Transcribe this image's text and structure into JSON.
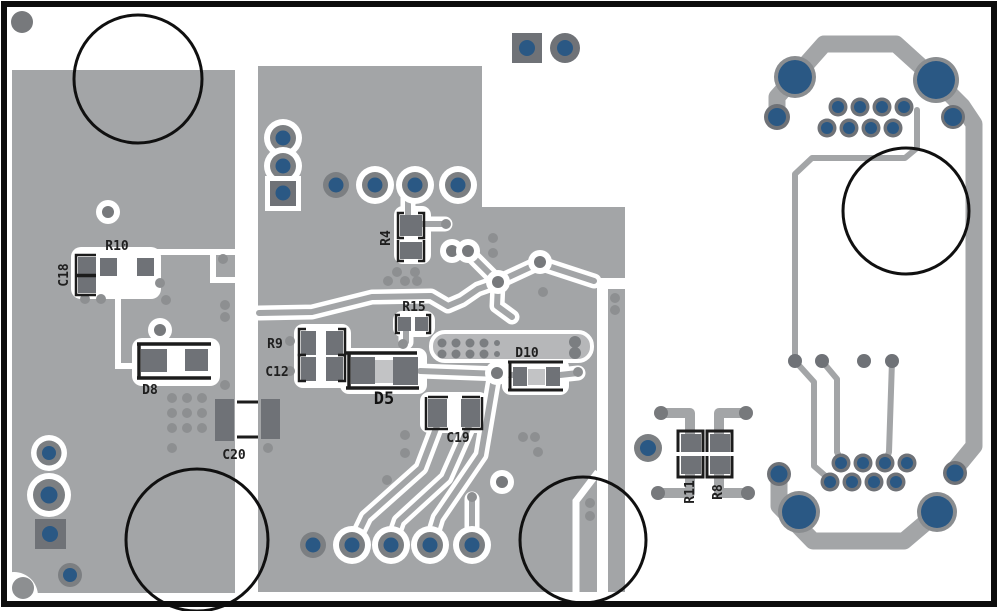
{
  "board": {
    "description": "PCB copper layer layout view (negative plane with clearances)",
    "colors": {
      "background": "#ffffff",
      "copper_pour": "#a3a5a7",
      "trace_gray": "#a3a5a7",
      "pad_gray": "#6f7277",
      "via_center_gray": "#77797c",
      "dot_gray": "#8d8f91",
      "drill_blue": "#2a5884",
      "silkscreen_black": "#1c1c1c",
      "board_outline": "#000000",
      "component_body": "#c2c3c5",
      "footprint_fill": "#b6b7b9"
    },
    "components": [
      {
        "ref": "R10",
        "type": "resistor"
      },
      {
        "ref": "C18",
        "type": "capacitor"
      },
      {
        "ref": "D8",
        "type": "diode"
      },
      {
        "ref": "C20",
        "type": "capacitor"
      },
      {
        "ref": "R4",
        "type": "resistor"
      },
      {
        "ref": "R15",
        "type": "resistor"
      },
      {
        "ref": "R9",
        "type": "resistor"
      },
      {
        "ref": "C12",
        "type": "capacitor"
      },
      {
        "ref": "D5",
        "type": "diode"
      },
      {
        "ref": "D10",
        "type": "diode"
      },
      {
        "ref": "C19",
        "type": "capacitor"
      },
      {
        "ref": "R11",
        "type": "resistor"
      },
      {
        "ref": "R8",
        "type": "resistor"
      }
    ],
    "mounting_holes": 4,
    "connectors": {
      "top_right": {
        "signal_pins": 8,
        "shell_pads": 4
      },
      "bottom_right": {
        "signal_pins": 8,
        "shell_pads": 4
      }
    },
    "headers": {
      "left_3pin": 3
    }
  }
}
